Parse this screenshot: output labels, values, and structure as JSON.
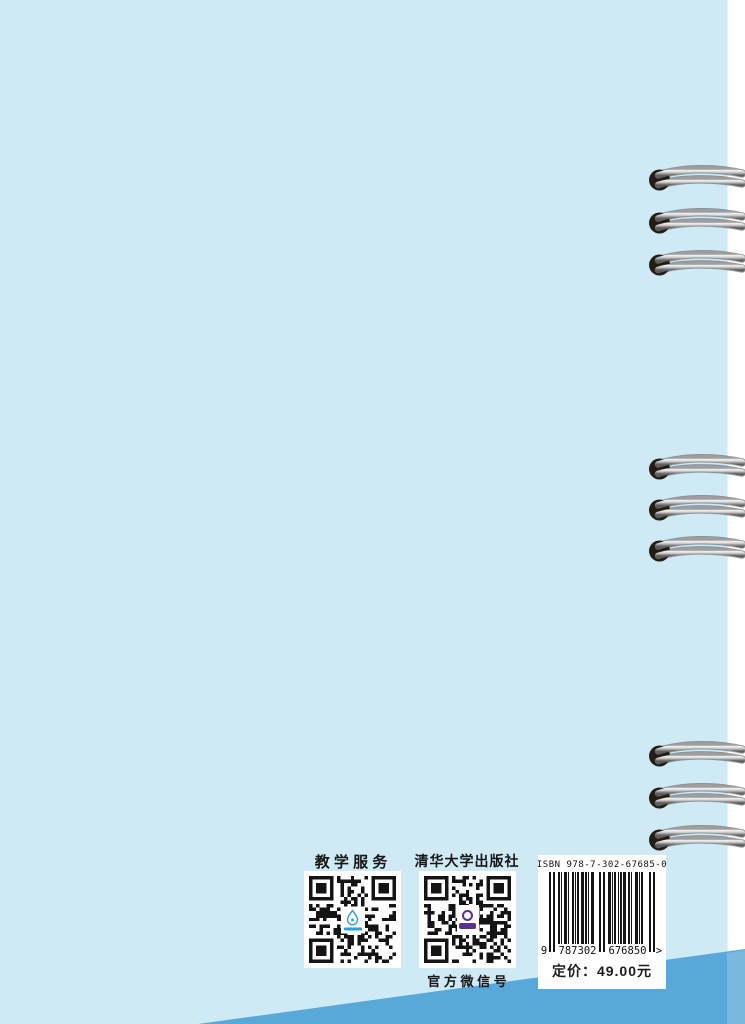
{
  "cover": {
    "background_color": "#cfe9f5",
    "band_color": "#58a8da",
    "band_edge_color": "#7ab8e0",
    "edge_strip_color": "#ffffff"
  },
  "footer": {
    "teaching_service_label": "教 学 服 务",
    "publisher_label": "清华大学出版社",
    "wechat_label": "官 方 微 信 号"
  },
  "barcode": {
    "isbn_text": "ISBN 978-7-302-67685-0",
    "digit_lead": "9",
    "digit_group1": "787302",
    "digit_group2": "676850",
    "digit_tail": ">",
    "price_text": "定价：49.00元"
  },
  "binding": {
    "ring_left_x": 648,
    "ring_row_centers": [
      180,
      223,
      265,
      469,
      510,
      551,
      756,
      798,
      840
    ]
  }
}
